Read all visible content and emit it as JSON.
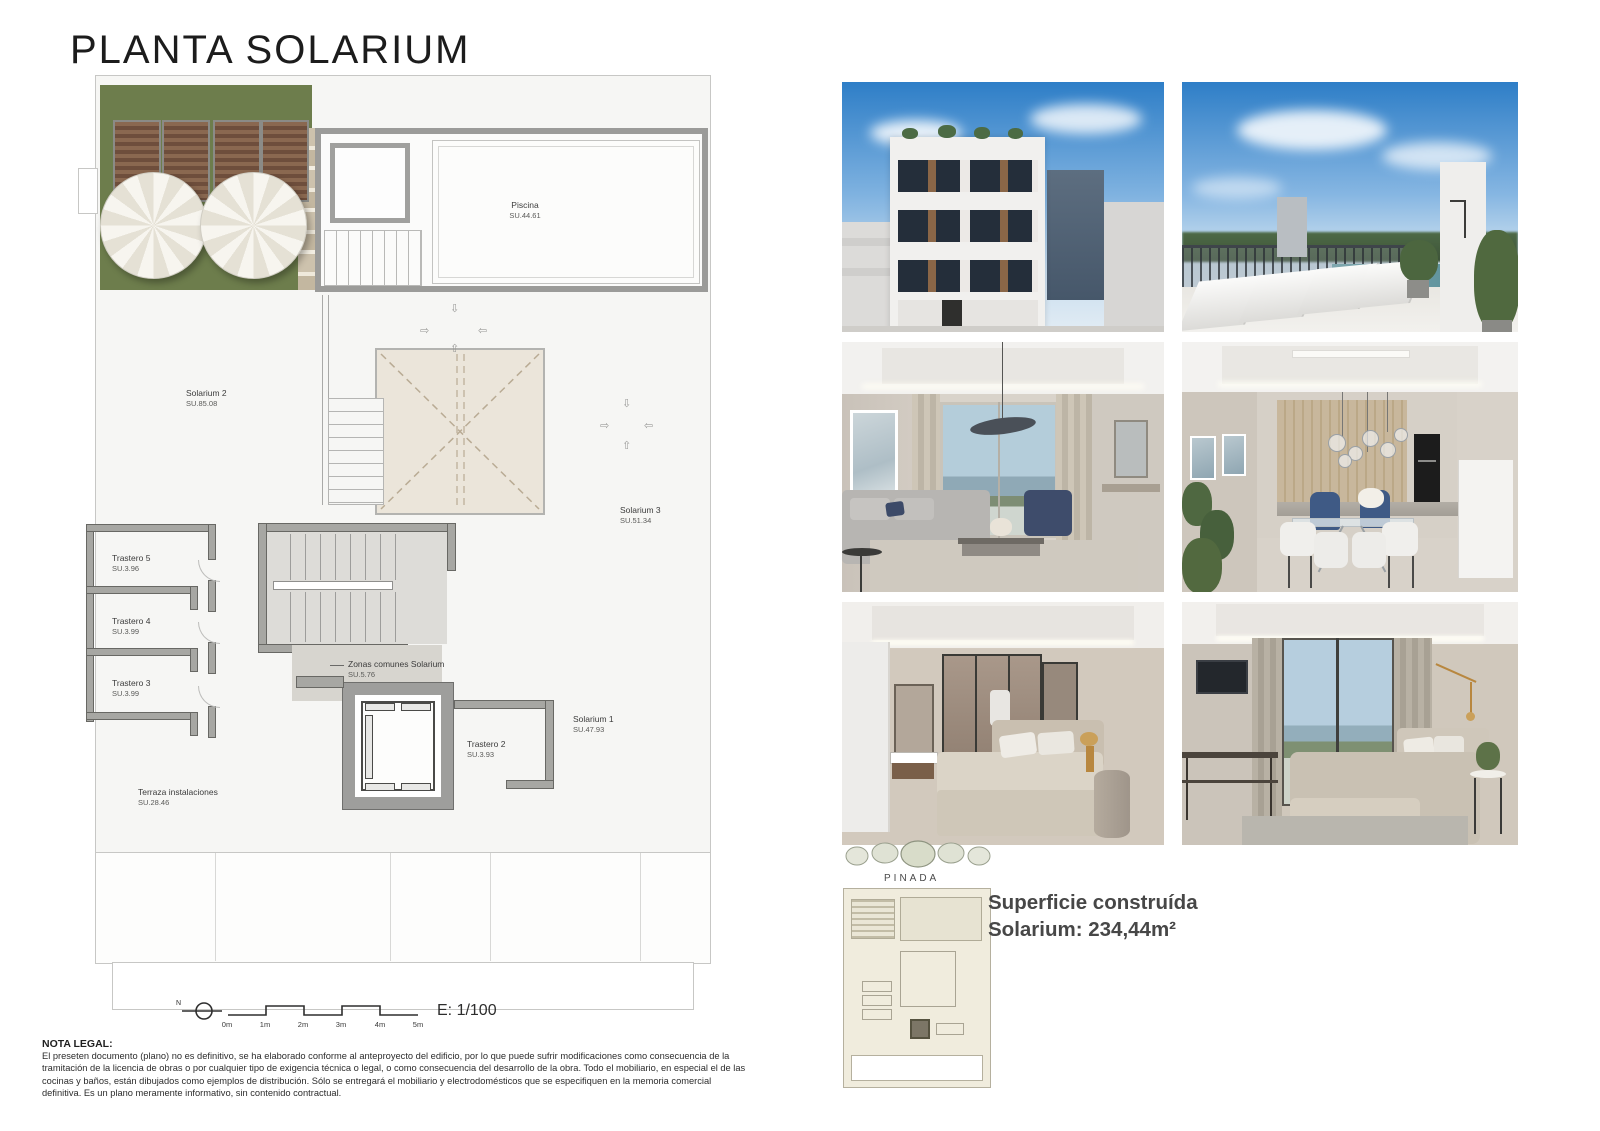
{
  "page": {
    "title": "PLANTA SOLARIUM"
  },
  "plan": {
    "rooms": [
      {
        "name": "Piscina",
        "area": "SU.44.61"
      },
      {
        "name": "Solarium 2",
        "area": "SU.85.08"
      },
      {
        "name": "Solarium 3",
        "area": "SU.51.34"
      },
      {
        "name": "Trastero 5",
        "area": "SU.3.96"
      },
      {
        "name": "Trastero 4",
        "area": "SU.3.99"
      },
      {
        "name": "Trastero 3",
        "area": "SU.3.99"
      },
      {
        "name": "Zonas comunes Solarium",
        "area": "SU.5.76"
      },
      {
        "name": "Solarium 1",
        "area": "SU.47.93"
      },
      {
        "name": "Trastero 2",
        "area": "SU.3.93"
      },
      {
        "name": "Terraza instalaciones",
        "area": "SU.28.46"
      }
    ],
    "compass_label": "N",
    "scale_ticks": [
      "0m",
      "1m",
      "2m",
      "3m",
      "4m",
      "5m"
    ],
    "scale_ratio": "E: 1/100"
  },
  "site_plan": {
    "label": "PINADA"
  },
  "summary": {
    "line1": "Superficie construída",
    "line2": "Solarium: 234,44m²"
  },
  "legal": {
    "heading": "NOTA LEGAL:",
    "body": "El preseten documento (plano) no es definitivo, se ha elaborado conforme al anteproyecto del edificio, por lo que puede sufrir modificaciones como consecuencia de la tramitación de la licencia de obras o por cualquier tipo de exigencia técnica o legal, o como consecuencia del desarrollo de la obra. Todo el mobiliario, en especial el de las cocinas y baños, están dibujados como ejemplos de distribución. Sólo se entregará el mobiliario y electrodomésticos que se especifiquen en la memoria comercial definitiva. Es un plano meramente informativo, sin contenido contractual."
  },
  "colors": {
    "terrace_green": "#6d7d4c",
    "wall_grey": "#a7a7a3",
    "skylight_beige": "#ebe5da",
    "sky_blue": "#2e7ec7"
  }
}
